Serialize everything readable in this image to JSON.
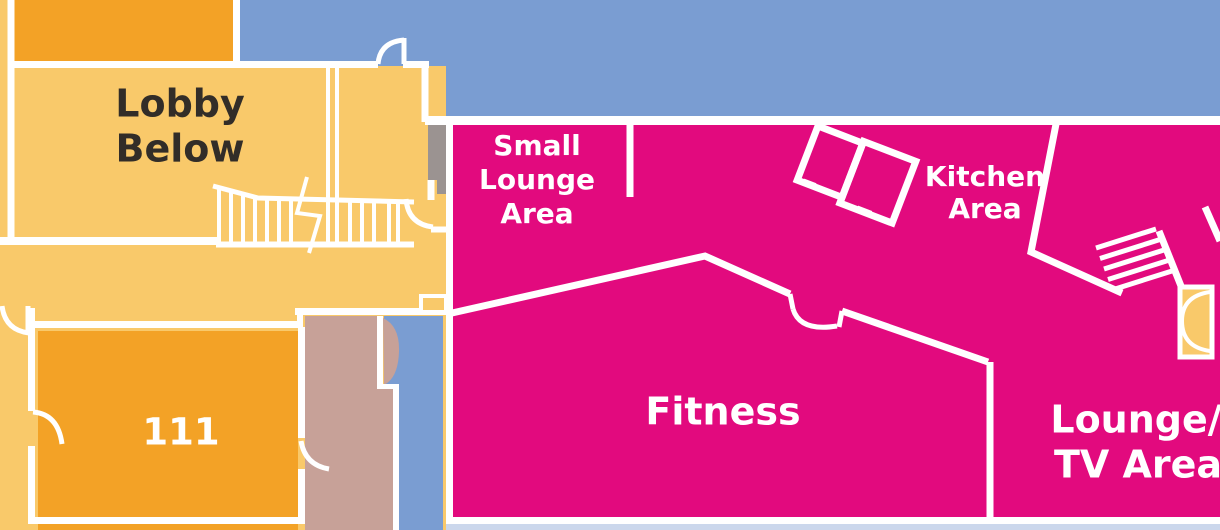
{
  "title": "Floor plan - upper level",
  "colors": {
    "light_orange": "#F9C96A",
    "dark_orange": "#F3A226",
    "blue": "#7A9DD2",
    "magenta": "#E20A7E",
    "mauve": "#C7A198",
    "gray": "#9B9391",
    "pale_blue": "#CBD7EC",
    "wall_white": "#FFFFFF",
    "text_dark": "#322D28",
    "text_light": "#FFFFFF"
  },
  "rooms": {
    "lobby": {
      "line1": "Lobby",
      "line2": "Below"
    },
    "room111": {
      "label": "111"
    },
    "small_lounge": {
      "line1": "Small",
      "line2": "Lounge",
      "line3": "Area"
    },
    "kitchen": {
      "line1": "Kitchen",
      "line2": "Area"
    },
    "fitness": {
      "label": "Fitness"
    },
    "lounge_tv": {
      "line1": "Lounge/",
      "line2": "TV Area"
    }
  }
}
